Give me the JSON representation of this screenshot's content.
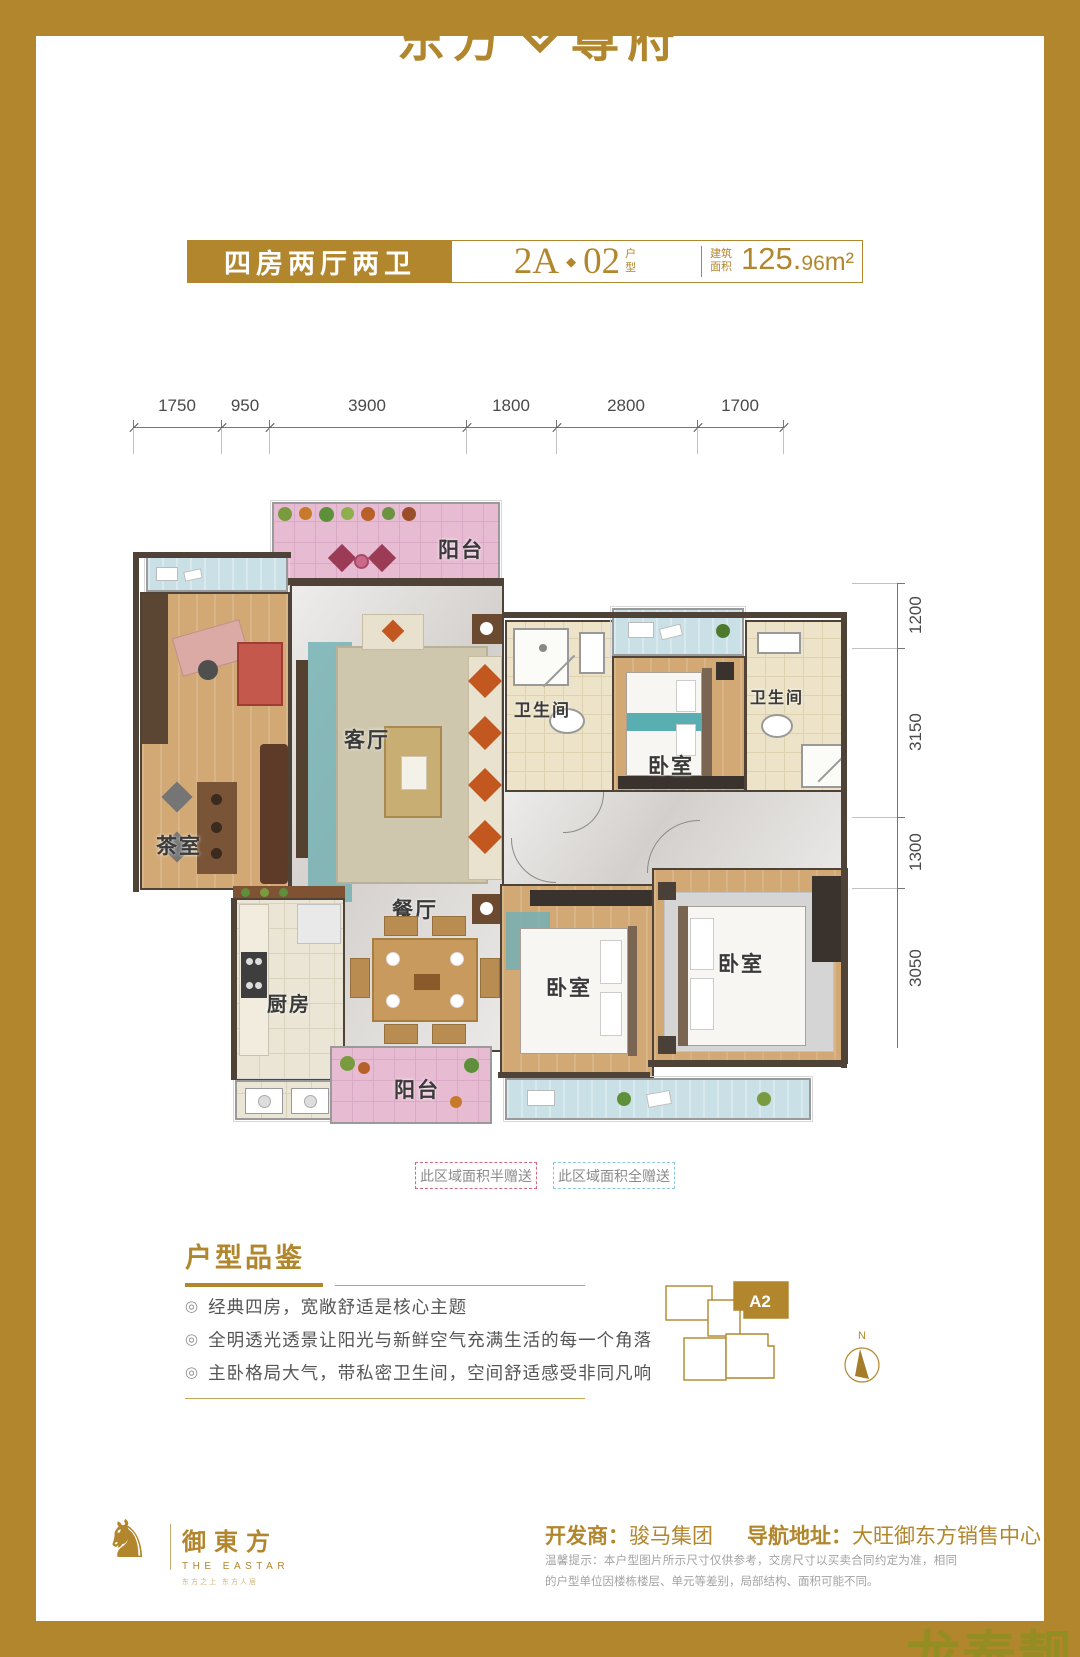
{
  "brand": {
    "name_left": "东方",
    "name_right": "尊府",
    "tagline_bar": "‖",
    "tagline_left": "双园藏天下",
    "tagline_right": "一宅御东方"
  },
  "header": {
    "unit_type": "四房两厅两卫",
    "unit_a": "2A",
    "unit_sep": "◆",
    "unit_b": "02",
    "unit_suffix": "户型",
    "area_label": "建筑面积",
    "area_main": "125.",
    "area_small": "96",
    "area_unit": "m²"
  },
  "dims": {
    "top": [
      "1750",
      "950",
      "3900",
      "1800",
      "2800",
      "1700"
    ],
    "right": [
      "1200",
      "3150",
      "1300",
      "3050"
    ]
  },
  "floorplan": {
    "balcony_top": "阳台",
    "tea_room": "茶室",
    "living_room": "客厅",
    "bathroom_1": "卫生间",
    "bedroom_1": "卧室",
    "bathroom_2": "卫生间",
    "dining_room": "餐厅",
    "kitchen": "厨房",
    "balcony_bottom": "阳台",
    "bedroom_2": "卧室",
    "bedroom_3": "卧室"
  },
  "legend": {
    "half": "此区域面积半赠送",
    "full": "此区域面积全赠送"
  },
  "features": {
    "title": "户型品鉴",
    "marker": "◎",
    "bullets": [
      "经典四房，宽敞舒适是核心主题",
      "全明透光透景让阳光与新鲜空气充满生活的每一个角落",
      "主卧格局大气，带私密卫生间，空间舒适感受非同凡响"
    ]
  },
  "keyplan": {
    "unit": "A2",
    "compass": "N"
  },
  "footer": {
    "developer_label": "开发商：",
    "developer": "骏马集团",
    "nav_label": "导航地址：",
    "nav": "大旺御东方销售中心",
    "disclaimer": "温馨提示：本户型图片所示尺寸仅供参考，交房尺寸以买卖合同约定为准，相同的户型单位因楼栋楼层、单元等差别，局部结构、面积可能不同。"
  },
  "bottom_logo": {
    "horse_glyph": "♞",
    "cn": "御東方",
    "en": "THE EASTAR",
    "tagline": "东方之上 东方人居"
  },
  "watermark": {
    "text": "龙泰靓居"
  },
  "colors": {
    "gold": "#b2862c",
    "legend_half": "#d4687e",
    "legend_full": "#8ec6da"
  }
}
